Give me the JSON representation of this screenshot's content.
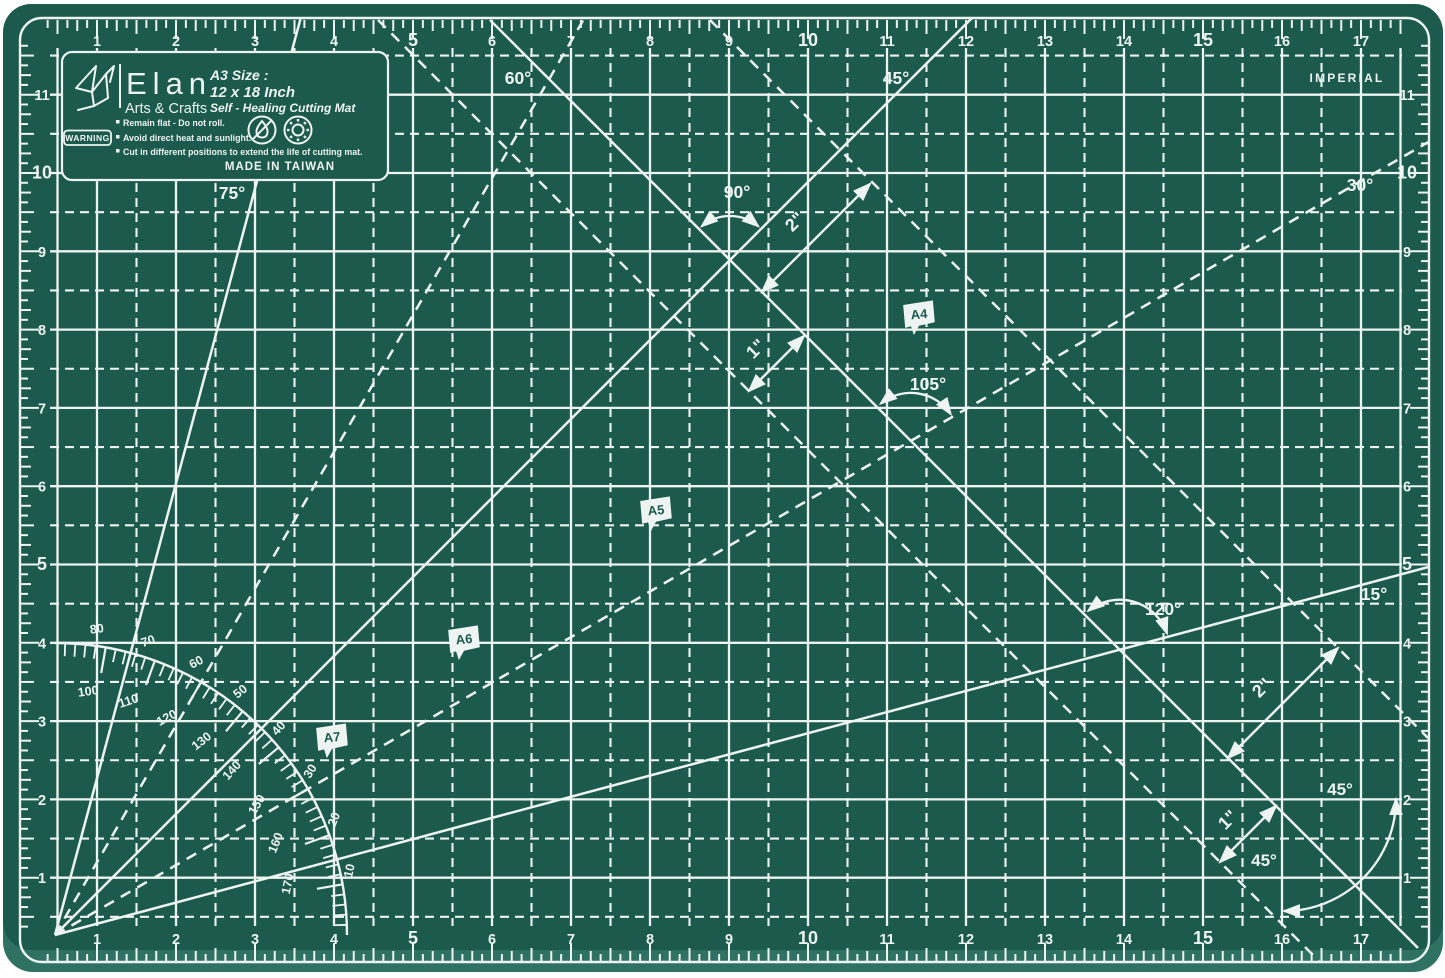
{
  "colors": {
    "page_bg": "#ffffff",
    "mat": "#1b5a4d",
    "mat_edge": "#2f7263",
    "line": "#eef4f1"
  },
  "unit_label": "IMPERIAL",
  "brand": {
    "name": "Elan",
    "subtitle": "Arts & Crafts",
    "size_label": "A3 Size :",
    "size_value": "12 x 18 Inch",
    "tagline": "Self - Healing Cutting Mat",
    "warning_badge": "WARNING",
    "warnings": [
      "Remain flat - Do not roll.",
      "Avoid direct heat and sunlight.",
      "Cut in different positions to extend the life of cutting mat."
    ],
    "made_in": "MADE IN TAIWAN"
  },
  "ruler": {
    "top": [
      1,
      2,
      3,
      4,
      5,
      6,
      7,
      8,
      9,
      10,
      11,
      12,
      13,
      14,
      15,
      16,
      17
    ],
    "bottom": [
      1,
      2,
      3,
      4,
      5,
      6,
      7,
      8,
      9,
      10,
      11,
      12,
      13,
      14,
      15,
      16,
      17
    ],
    "left": [
      1,
      2,
      3,
      4,
      5,
      6,
      7,
      8,
      9,
      10,
      11
    ],
    "right": [
      1,
      2,
      3,
      4,
      5,
      6,
      7,
      8,
      9,
      10,
      11
    ],
    "bold_multiple": 5
  },
  "grid": {
    "x0": 18,
    "sx": 79.0,
    "y0": 956,
    "sy": 78.3,
    "cols": 17,
    "rows": 11
  },
  "origin": {
    "x": 55,
    "y": 935
  },
  "rays": [
    {
      "deg": 75,
      "dashed": false,
      "label": "75°",
      "label_x": 232,
      "label_y": 199
    },
    {
      "deg": 60,
      "dashed": true,
      "label": "60°",
      "label_x": 518,
      "label_y": 84
    },
    {
      "deg": 45,
      "dashed": false,
      "label": "45°",
      "label_x": 896,
      "label_y": 84
    },
    {
      "deg": 30,
      "dashed": true,
      "label": "30°",
      "label_x": 1360,
      "label_y": 191
    },
    {
      "deg": 15,
      "dashed": false,
      "label": "15°",
      "label_x": 1374,
      "label_y": 600
    }
  ],
  "diagonals": [
    {
      "name": "diagonal-45-solid",
      "dashed": false,
      "clipped": false,
      "x1": 490,
      "y1": 20,
      "x2": 1418,
      "y2": 948
    },
    {
      "name": "diagonal-45-dashed-upper",
      "dashed": true,
      "clipped": true,
      "x1": 710,
      "y1": 20,
      "x2": 1428,
      "y2": 738
    },
    {
      "name": "diagonal-45-dashed-lower",
      "dashed": true,
      "clipped": true,
      "x1": 378,
      "y1": 20,
      "x2": 1319,
      "y2": 961
    }
  ],
  "angle_arcs": [
    {
      "label": "90°",
      "cx": 730,
      "cy": 260,
      "r": 44,
      "from": 50,
      "to": 130,
      "label_x": 737,
      "label_y": 198
    },
    {
      "label": "105°",
      "cx": 910.9,
      "cy": 440.9,
      "r": 48,
      "from": 34,
      "to": 129,
      "label_x": 928,
      "label_y": 390
    },
    {
      "label": "120°",
      "cx": 1119.7,
      "cy": 649.7,
      "r": 50,
      "from": 19,
      "to": 129,
      "label_x": 1163,
      "label_y": 615
    }
  ],
  "corner_arc": {
    "x1": 1396,
    "y1": 799,
    "x2": 1284,
    "y2": 911,
    "r": 112,
    "labels": [
      {
        "text": "45°",
        "x": 1340,
        "y": 795
      },
      {
        "text": "45°",
        "x": 1264,
        "y": 866
      }
    ]
  },
  "measure_arrows": [
    {
      "label": "2\"",
      "x1": 762,
      "y1": 292,
      "x2": 870,
      "y2": 184,
      "label_x": 799,
      "label_y": 226
    },
    {
      "label": "1\"",
      "x1": 749,
      "y1": 391,
      "x2": 804,
      "y2": 336,
      "label_x": 760,
      "label_y": 353
    },
    {
      "label": "2\"",
      "x1": 1228,
      "y1": 758,
      "x2": 1338,
      "y2": 648,
      "label_x": 1266,
      "label_y": 692
    },
    {
      "label": "1\"",
      "x1": 1220,
      "y1": 862,
      "x2": 1276,
      "y2": 806,
      "label_x": 1232,
      "label_y": 824
    }
  ],
  "flags": [
    {
      "label": "A4",
      "x": 903,
      "y": 303
    },
    {
      "label": "A5",
      "x": 640,
      "y": 499
    },
    {
      "label": "A6",
      "x": 448,
      "y": 628
    },
    {
      "label": "A7",
      "x": 316,
      "y": 726
    }
  ],
  "protractor": {
    "radius": 292,
    "outer_labels": [
      80,
      70,
      60,
      50,
      40,
      30,
      20,
      10
    ],
    "inner_labels": [
      100,
      110,
      120,
      130,
      140,
      150,
      160,
      170
    ]
  }
}
